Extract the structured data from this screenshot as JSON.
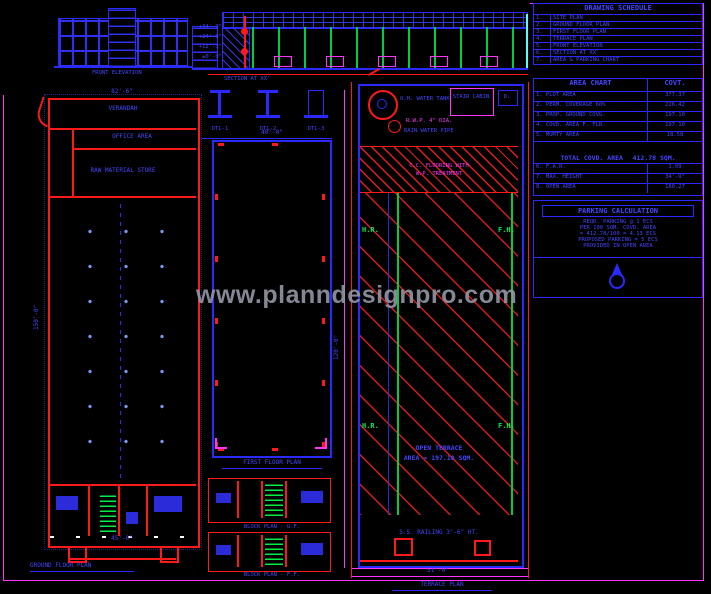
{
  "watermark": "www.planndesignpro.com",
  "schedule": {
    "title": "DRAWING SCHEDULE",
    "rows": [
      {
        "no": "1.",
        "label": "SITE PLAN"
      },
      {
        "no": "2.",
        "label": "GROUND FLOOR PLAN"
      },
      {
        "no": "3.",
        "label": "FIRST FLOOR PLAN"
      },
      {
        "no": "4.",
        "label": "TERRACE PLAN"
      },
      {
        "no": "5.",
        "label": "FRONT ELEVATION"
      },
      {
        "no": "6.",
        "label": "SECTION AT XX'"
      },
      {
        "no": "7.",
        "label": "AREA & PARKING CHART"
      }
    ]
  },
  "area_chart": {
    "header_left": "AREA CHART",
    "header_right": "COVT.",
    "rows": [
      {
        "label": "1. PLOT AREA",
        "value": "377.37"
      },
      {
        "label": "2. PERM. COVERAGE 60%",
        "value": "226.42"
      },
      {
        "label": "3. PROP. GROUND COVG.",
        "value": "197.10"
      },
      {
        "label": "4. COVD. AREA F. FLR.",
        "value": "197.10"
      },
      {
        "label": "5. MUMTY AREA",
        "value": "18.58"
      }
    ],
    "total_label": "TOTAL COVD. AREA",
    "total_value": "412.78 SQM.",
    "rows2": [
      {
        "label": "6. F.A.R.",
        "value": "1.09"
      },
      {
        "label": "7. MAX. HEIGHT",
        "value": "34'-9\""
      },
      {
        "label": "8. OPEN AREA",
        "value": "180.27"
      }
    ]
  },
  "parking": {
    "title": "PARKING CALCULATION",
    "lines": [
      "REQD. PARKING @ 1 ECS",
      "PER 100 SQM. COVD. AREA",
      "= 412.78/100 = 4.13 ECS",
      "PROPOSED PARKING = 5 ECS",
      "PROVIDED IN OPEN AREA"
    ]
  },
  "section": {
    "title": "SECTION AT XX'",
    "levels": [
      "+34'-9\"",
      "+24'-6\"",
      "+12'-3\"",
      "±0'-0\""
    ]
  },
  "elevation": {
    "title": "FRONT ELEVATION"
  },
  "details": {
    "items": [
      "DTL-1",
      "DTL-2",
      "DTL-3"
    ]
  },
  "left_plan": {
    "dim_top": "82'-6\"",
    "dim_left": "150'-0\"",
    "room1": "VERANDAH",
    "room2": "OFFICE AREA",
    "room3": "RAW MATERIAL STORE",
    "dim_bottom": "45'-0\"",
    "title": "GROUND FLOOR PLAN"
  },
  "middle_plan": {
    "dim_top": "40'-0\"",
    "title": "FIRST FLOOR PLAN"
  },
  "strip_plans": {
    "first": "BLOCK PLAN - G.F.",
    "second": "BLOCK PLAN - F.F."
  },
  "right_plan": {
    "tank": "O.H. WATER TANK",
    "cabin": "STAIR CABIN",
    "box2": "D.",
    "note_magenta": "R.W.P. 4\" DIA.",
    "note_blue": "RAIN WATER PIPE",
    "band1": "C.C. FLOORING WITH",
    "band2": "W.P. TREATMENT",
    "center1": "OPEN TERRACE",
    "center2": "AREA = 197.10 SQM.",
    "bottom_note": "S.S. RAILING 3'-6\" HT.",
    "dim_bottom": "51'-0\"",
    "dim_left": "120'-0\"",
    "title": "TERRACE PLAN"
  },
  "labels": {
    "hr": "H.R.",
    "fh": "F.H."
  }
}
